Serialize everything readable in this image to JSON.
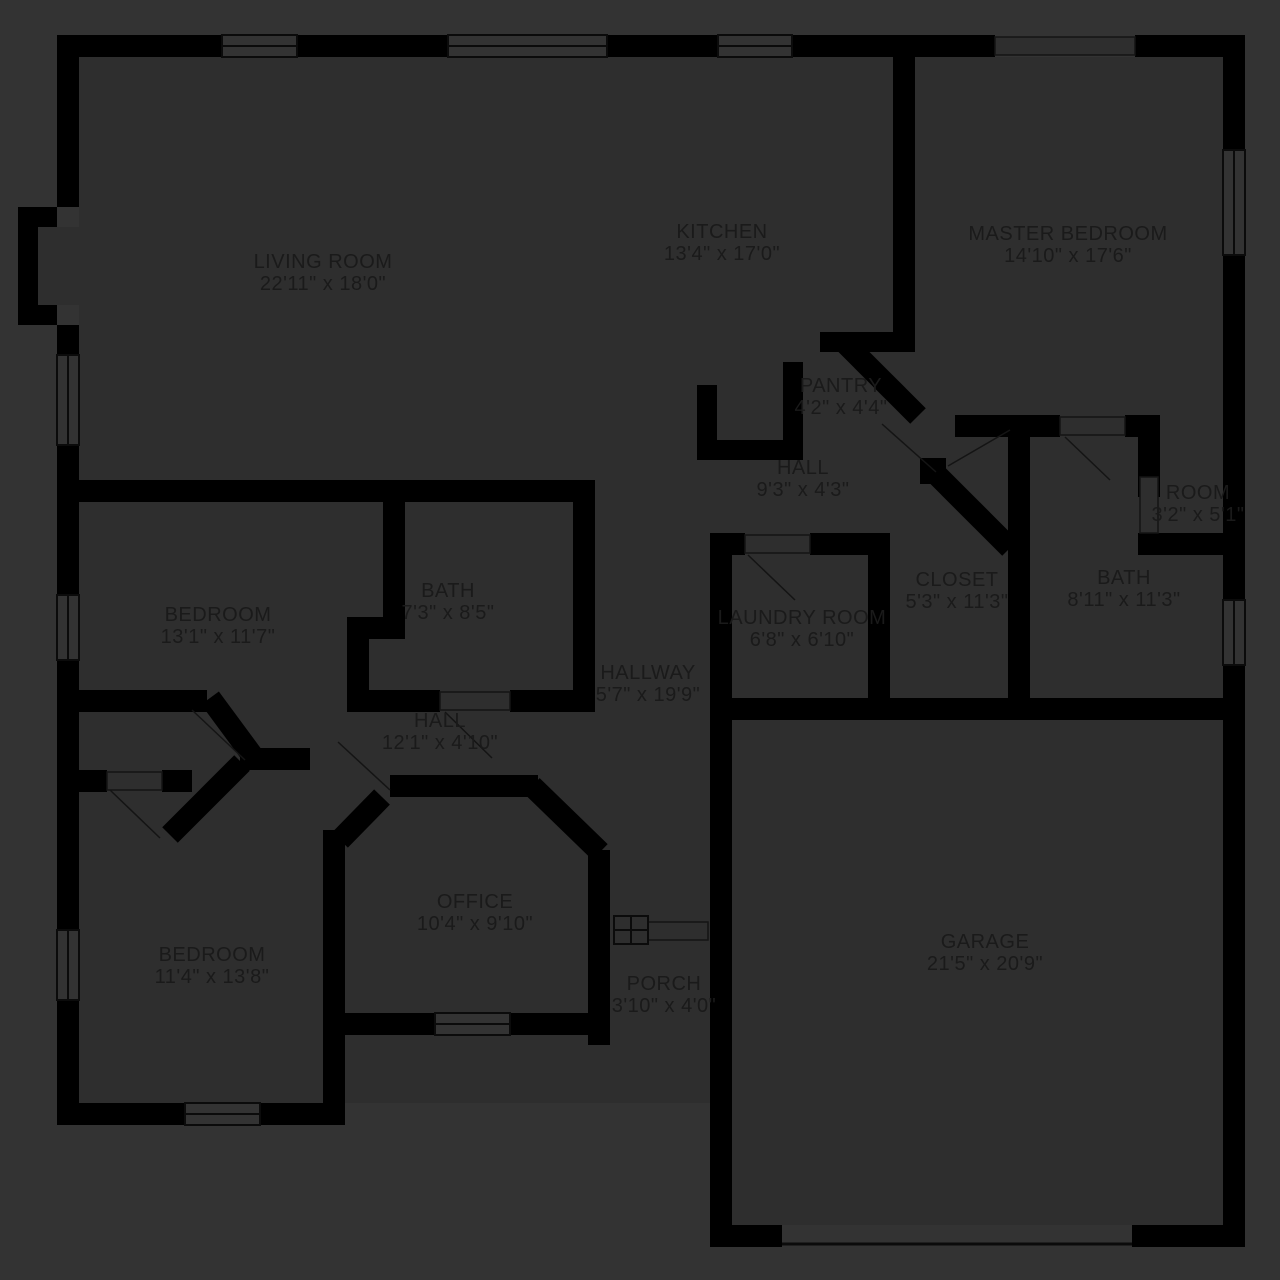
{
  "title": "Floor plan",
  "colors": {
    "background": "#333333",
    "floor": "#2e2e2e",
    "wall": "#000000",
    "window_line": "#0b0b0b",
    "text": "#1a1a1a"
  },
  "rooms": [
    {
      "id": "living-room",
      "name": "LIVING ROOM",
      "dims": "22'11\" x 18'0\""
    },
    {
      "id": "kitchen",
      "name": "KITCHEN",
      "dims": "13'4\" x 17'0\""
    },
    {
      "id": "master-bedroom",
      "name": "MASTER BEDROOM",
      "dims": "14'10\" x 17'6\""
    },
    {
      "id": "pantry",
      "name": "PANTRY",
      "dims": "4'2\" x 4'4\""
    },
    {
      "id": "hall-upper",
      "name": "HALL",
      "dims": "9'3\" x 4'3\""
    },
    {
      "id": "room",
      "name": "ROOM",
      "dims": "3'2\" x 5'1\""
    },
    {
      "id": "bath-master",
      "name": "BATH",
      "dims": "8'11\" x 11'3\""
    },
    {
      "id": "bedroom-middle",
      "name": "BEDROOM",
      "dims": "13'1\" x 11'7\""
    },
    {
      "id": "bath-middle",
      "name": "BATH",
      "dims": "7'3\" x 8'5\""
    },
    {
      "id": "closet",
      "name": "CLOSET",
      "dims": "5'3\" x 11'3\""
    },
    {
      "id": "laundry-room",
      "name": "LAUNDRY ROOM",
      "dims": "6'8\" x 6'10\""
    },
    {
      "id": "hallway",
      "name": "HALLWAY",
      "dims": "5'7\" x 19'9\""
    },
    {
      "id": "hall-lower",
      "name": "HALL",
      "dims": "12'1\" x 4'10\""
    },
    {
      "id": "office",
      "name": "OFFICE",
      "dims": "10'4\" x 9'10\""
    },
    {
      "id": "bedroom-lower",
      "name": "BEDROOM",
      "dims": "11'4\" x 13'8\""
    },
    {
      "id": "porch",
      "name": "PORCH",
      "dims": "3'10\" x 4'0\""
    },
    {
      "id": "garage",
      "name": "GARAGE",
      "dims": "21'5\" x 20'9\""
    }
  ]
}
